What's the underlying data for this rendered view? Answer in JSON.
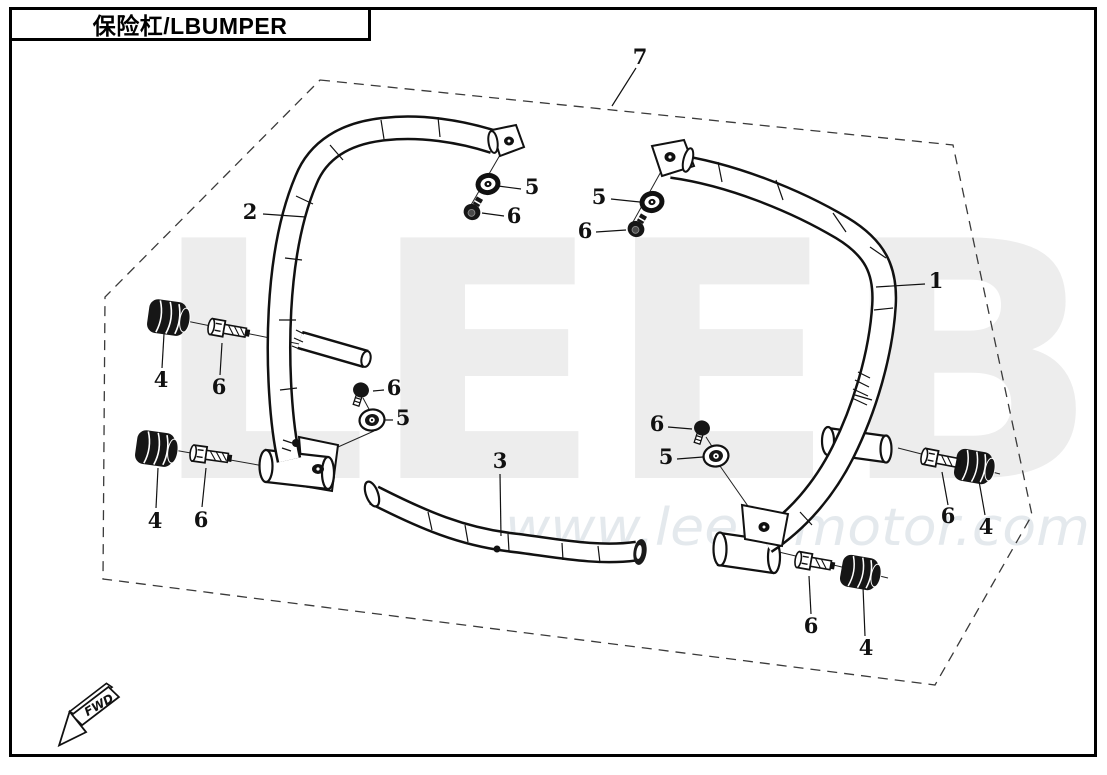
{
  "title_box": {
    "title": "保险杠/LBUMPER"
  },
  "watermark": {
    "brand": "LEEB",
    "url": "www.leeb-motor.com",
    "brand_color": "#ededed",
    "url_color": "#e4e9ed"
  },
  "direction_arrow": {
    "label": "FWD"
  },
  "diagram": {
    "type": "exploded-parts-diagram",
    "line_color": "#1a1a1a",
    "visible_part_numbers": [
      "1",
      "2",
      "3",
      "4",
      "5",
      "6",
      "7"
    ]
  },
  "callouts": [
    {
      "label": "7",
      "x": 640,
      "y": 57,
      "leader": [
        636,
        68,
        612,
        106
      ]
    },
    {
      "label": "2",
      "x": 250,
      "y": 212,
      "leader": [
        263,
        214,
        306,
        217
      ]
    },
    {
      "label": "1",
      "x": 936,
      "y": 281,
      "leader": [
        925,
        284,
        876,
        287
      ]
    },
    {
      "label": "3",
      "x": 500,
      "y": 461,
      "leader": [
        500,
        474,
        501,
        536
      ]
    },
    {
      "label": "5",
      "x": 532,
      "y": 187,
      "leader": [
        521,
        189,
        498,
        186
      ]
    },
    {
      "label": "6",
      "x": 514,
      "y": 216,
      "leader": [
        504,
        216,
        482,
        213
      ]
    },
    {
      "label": "5",
      "x": 599,
      "y": 197,
      "leader": [
        611,
        199,
        640,
        202
      ]
    },
    {
      "label": "6",
      "x": 585,
      "y": 231,
      "leader": [
        596,
        232,
        626,
        230
      ]
    },
    {
      "label": "4",
      "x": 161,
      "y": 380,
      "leader": [
        162,
        368,
        164,
        334
      ]
    },
    {
      "label": "6",
      "x": 219,
      "y": 387,
      "leader": [
        220,
        375,
        222,
        343
      ]
    },
    {
      "label": "4",
      "x": 155,
      "y": 521,
      "leader": [
        156,
        508,
        158,
        468
      ]
    },
    {
      "label": "6",
      "x": 201,
      "y": 520,
      "leader": [
        202,
        507,
        206,
        468
      ]
    },
    {
      "label": "6",
      "x": 394,
      "y": 388,
      "leader": [
        384,
        390,
        373,
        391
      ]
    },
    {
      "label": "5",
      "x": 403,
      "y": 418,
      "leader": [
        393,
        420,
        384,
        420
      ]
    },
    {
      "label": "6",
      "x": 657,
      "y": 424,
      "leader": [
        668,
        427,
        692,
        429
      ]
    },
    {
      "label": "5",
      "x": 666,
      "y": 457,
      "leader": [
        677,
        459,
        703,
        457
      ]
    },
    {
      "label": "6",
      "x": 948,
      "y": 516,
      "leader": [
        948,
        505,
        942,
        472
      ]
    },
    {
      "label": "4",
      "x": 986,
      "y": 527,
      "leader": [
        985,
        515,
        979,
        481
      ]
    },
    {
      "label": "6",
      "x": 811,
      "y": 626,
      "leader": [
        811,
        614,
        809,
        576
      ]
    },
    {
      "label": "4",
      "x": 866,
      "y": 648,
      "leader": [
        865,
        636,
        863,
        587
      ]
    }
  ]
}
